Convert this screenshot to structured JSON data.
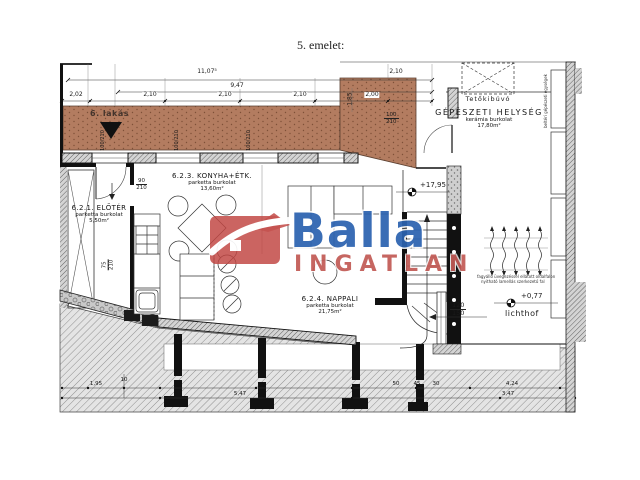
{
  "title": "5. emelet:",
  "logo": {
    "brand": "Balla",
    "sub": "INGATLAN",
    "brand_color": "#2c63b0",
    "sub_color": "#c25b56",
    "house_color": "#c14642"
  },
  "rooms": {
    "eloter": {
      "name": "6.2.1. ELŐTÉR",
      "floor": "parketta burkolat",
      "area": "5,50m²"
    },
    "konyha": {
      "name": "6.2.3. KONYHA+ÉTK.",
      "floor": "parketta burkolat",
      "area": "13,60m²"
    },
    "nappali": {
      "name": "6.2.4. NAPPALI",
      "floor": "parketta burkolat",
      "area": "21,75m²"
    },
    "gepeszeti": {
      "name": "GÉPÉSZETI HELYSÉG",
      "floor": "kerámia burkolat",
      "area": "17,80m²"
    }
  },
  "annotations": {
    "apartment": "6. lakás",
    "roof_hatch": "Tetőkibúvó",
    "lichthof": "lichthof",
    "level_upper": "+17,95",
    "level_lower": "+0,77",
    "wall_note_1": "fagyálló üvegezéssel ellátott oldalfalon",
    "wall_note_2": "nyitható lamellás szerkezetű fal",
    "side_note": "beltéri gépészeti egységek"
  },
  "dimensions": {
    "total": "11,07⁵",
    "subtotal": "9,47",
    "top": [
      "2,02",
      "2,10",
      "2,10",
      "2,10",
      "2,00"
    ],
    "top_right": "2,10",
    "depth": "1,85",
    "bottom": [
      "1,95",
      "10",
      "50",
      "45",
      "30",
      "4,24",
      "3,47",
      "5,47"
    ]
  },
  "openings": {
    "window_w": "100",
    "window_h": "210",
    "door_konyha_w": "90",
    "door_konyha_h": "210",
    "door_eloter_w": "75",
    "door_eloter_h": "210",
    "lichthof_w": "120",
    "lichthof_h": "150"
  },
  "colors": {
    "terrace": "#b37c60",
    "wall": "#111111"
  }
}
